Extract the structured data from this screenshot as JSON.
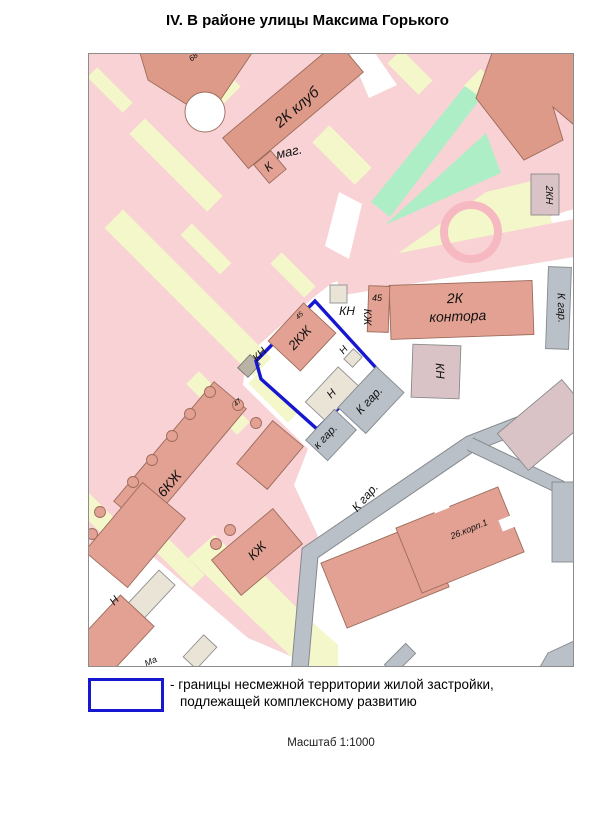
{
  "title": "IV. В районе улицы Максима Горького",
  "legend": {
    "symbol": "boundary-rectangle",
    "line1": "- границы несмежной территории жилой застройки,",
    "line2": "подлежащей комплексному развитию"
  },
  "scale_label": "Масштаб 1:1000",
  "map": {
    "colors": {
      "pink": "#f8d2d4",
      "path": "#f3f7c9",
      "green": "#aeeec6",
      "bld": "#e2a192",
      "bld_dark": "#dd9a89",
      "bldline": "#9c6b5c",
      "beige": "#e9e4d6",
      "beige2": "#b9b3a6",
      "pinkgray": "#d9c3c6",
      "road": "#b9c0c7",
      "boundary": "#1717cf",
      "ring": "#f6b9c2"
    },
    "labels": [
      {
        "text": "68-",
        "x": 108,
        "y": 5,
        "rot": -40,
        "size": 8
      },
      {
        "text": "2К клуб",
        "x": 212,
        "y": 58,
        "rot": -41,
        "size": 15
      },
      {
        "text": "маг.",
        "x": 202,
        "y": 103,
        "rot": -12,
        "size": 13
      },
      {
        "text": "К",
        "x": 183,
        "y": 117,
        "rot": -40,
        "size": 12
      },
      {
        "text": "2КН",
        "x": 458,
        "y": 142,
        "rot": 90,
        "size": 10
      },
      {
        "text": "2К",
        "x": 367,
        "y": 250,
        "rot": -2,
        "size": 14
      },
      {
        "text": "контора",
        "x": 370,
        "y": 268,
        "rot": -2,
        "size": 14
      },
      {
        "text": "45",
        "x": 289,
        "y": 248,
        "rot": 0,
        "size": 9
      },
      {
        "text": "КН",
        "x": 259,
        "y": 262,
        "rot": 0,
        "size": 12
      },
      {
        "text": "КЖ",
        "x": 276,
        "y": 264,
        "rot": 90,
        "size": 11
      },
      {
        "text": "К гар.",
        "x": 470,
        "y": 255,
        "rot": 88,
        "size": 11
      },
      {
        "text": "КН",
        "x": 348,
        "y": 318,
        "rot": 88,
        "size": 12
      },
      {
        "text": "КН",
        "x": 174,
        "y": 304,
        "rot": -45,
        "size": 11
      },
      {
        "text": "45",
        "x": 213,
        "y": 264,
        "rot": -45,
        "size": 7
      },
      {
        "text": "2КЖ",
        "x": 215,
        "y": 288,
        "rot": -47,
        "size": 13
      },
      {
        "text": "Н",
        "x": 258,
        "y": 299,
        "rot": -50,
        "size": 10
      },
      {
        "text": "Н",
        "x": 246,
        "y": 343,
        "rot": -47,
        "size": 11
      },
      {
        "text": "к гар.",
        "x": 240,
        "y": 386,
        "rot": -47,
        "size": 11
      },
      {
        "text": "К гар.",
        "x": 284,
        "y": 350,
        "rot": -47,
        "size": 12
      },
      {
        "text": "К гар.",
        "x": 280,
        "y": 447,
        "rot": -49,
        "size": 12
      },
      {
        "text": "47",
        "x": 151,
        "y": 351,
        "rot": -45,
        "size": 7
      },
      {
        "text": "6КЖ",
        "x": 85,
        "y": 434,
        "rot": -50,
        "size": 14
      },
      {
        "text": "КЖ",
        "x": 172,
        "y": 501,
        "rot": -45,
        "size": 13
      },
      {
        "text": "26.корп.1",
        "x": 382,
        "y": 479,
        "rot": -22,
        "size": 9
      },
      {
        "text": "Н",
        "x": 29,
        "y": 550,
        "rot": -47,
        "size": 11
      },
      {
        "text": "Ма",
        "x": 64,
        "y": 611,
        "rot": -25,
        "size": 9
      }
    ]
  }
}
